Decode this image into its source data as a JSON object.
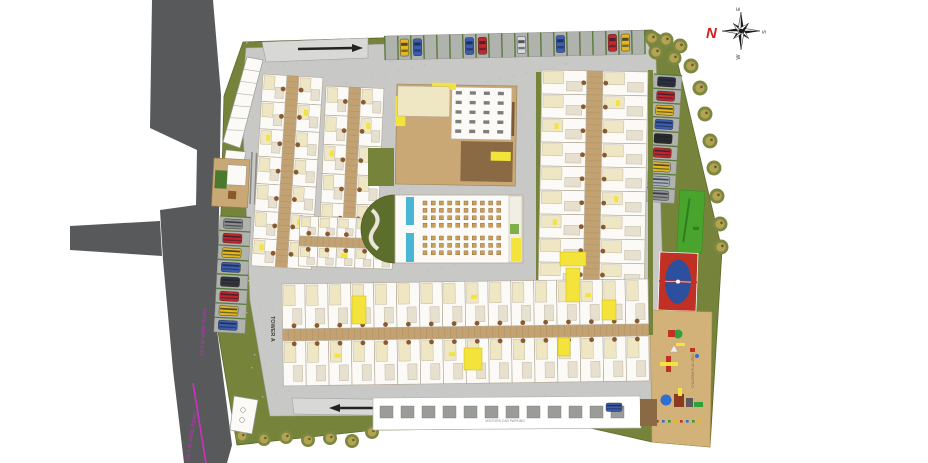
{
  "title": "Residential township site master plan",
  "compass": {
    "north": "N",
    "east": "E",
    "south": "S",
    "west": "W"
  },
  "labels": {
    "tower_a": "TOWER A",
    "road_upper": "24.0 M WIDE ROAD",
    "road_lower": "18.0 M WIDE ROAD",
    "children_play": "CHILDREN PLAY AREA",
    "visitors_parking": "VISITORS CAR PARKING"
  },
  "colors": {
    "road_dark": "#58595b",
    "paving": "#c8c8c6",
    "paving_dot": "#bdbdbb",
    "green": "#76833a",
    "green_bright": "#49a42d",
    "tree_outer": "#7c8840",
    "tree_inner": "#b3a352",
    "building_white": "#fbfaf6",
    "wall": "#b6ad9b",
    "cream": "#efe6c4",
    "corridor": "#c2a272",
    "wood": "#a9834f",
    "brown": "#8a5a2e",
    "deck_dark": "#7b5b3a",
    "yellow": "#f3e33b",
    "pool_blue": "#49b6d6",
    "court_red": "#c13024",
    "court_blue": "#2c4f9e",
    "sand": "#d2b279",
    "magenta": "#cf2fc4",
    "stall": "#b0b2ae",
    "stall_line": "#5a7a3a",
    "arrow": "#222222",
    "compass_red": "#d42020"
  },
  "parking": {
    "top_row_slots": 20,
    "top_row_cars": [
      {
        "slot": 1,
        "color": "#e3b81f"
      },
      {
        "slot": 2,
        "color": "#3b5db2"
      },
      {
        "slot": 6,
        "color": "#3b5db2"
      },
      {
        "slot": 7,
        "color": "#c1272d"
      },
      {
        "slot": 10,
        "color": "#d9d9d9"
      },
      {
        "slot": 13,
        "color": "#3b5db2"
      },
      {
        "slot": 17,
        "color": "#c1272d"
      },
      {
        "slot": 18,
        "color": "#e3b81f"
      }
    ],
    "left_column_cars": [
      "#8d8f91",
      "#c1272d",
      "#e3b81f",
      "#3b5db2",
      "#35363a",
      "#c1272d",
      "#e3b81f",
      "#3b5db2"
    ],
    "right_column_cars": [
      "#2e3040",
      "#c1272d",
      "#e3b81f",
      "#3b5db2",
      "#2a2a2a",
      "#c1272d",
      "#e3b81f",
      "#a9b2bc",
      "#8d8f91"
    ],
    "bottom_road_car": "#3b5db2"
  },
  "site": {
    "perimeter_tree_count_right": 13,
    "perimeter_tree_count_bottom": 7,
    "clubhouse_seat_grid": {
      "columns": 10,
      "rows_upper": 4,
      "rows_lower": 3
    }
  }
}
